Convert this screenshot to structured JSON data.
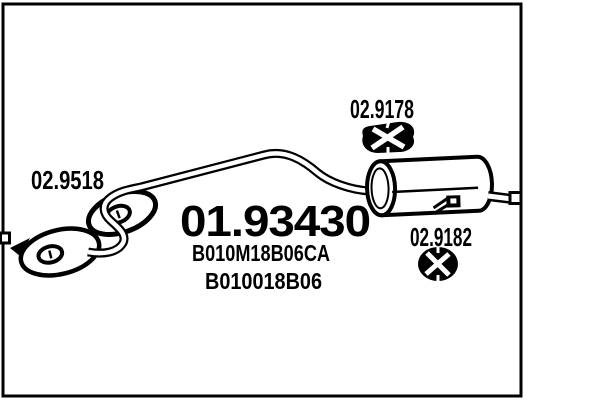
{
  "page": {
    "background": "#ffffff",
    "ink_color": "#000000"
  },
  "diagram": {
    "type": "exhaust-parts-catalog-drawing",
    "main_part_number": "01.93430",
    "oem_number_1": "B010M18B06CA",
    "oem_number_2": "B010018B06",
    "gasket_part_number": "02.9518",
    "hanger_top_part_number": "02.9178",
    "hanger_right_part_number": "02.9182"
  },
  "icons": {
    "left_upper": "ring-gasket-icon",
    "left_lower": "flange-gasket-icon",
    "top_right": "rubber-hanger-icon",
    "mid_right": "rubber-mount-icon",
    "drawing": "rear-muffler-silhouette"
  }
}
